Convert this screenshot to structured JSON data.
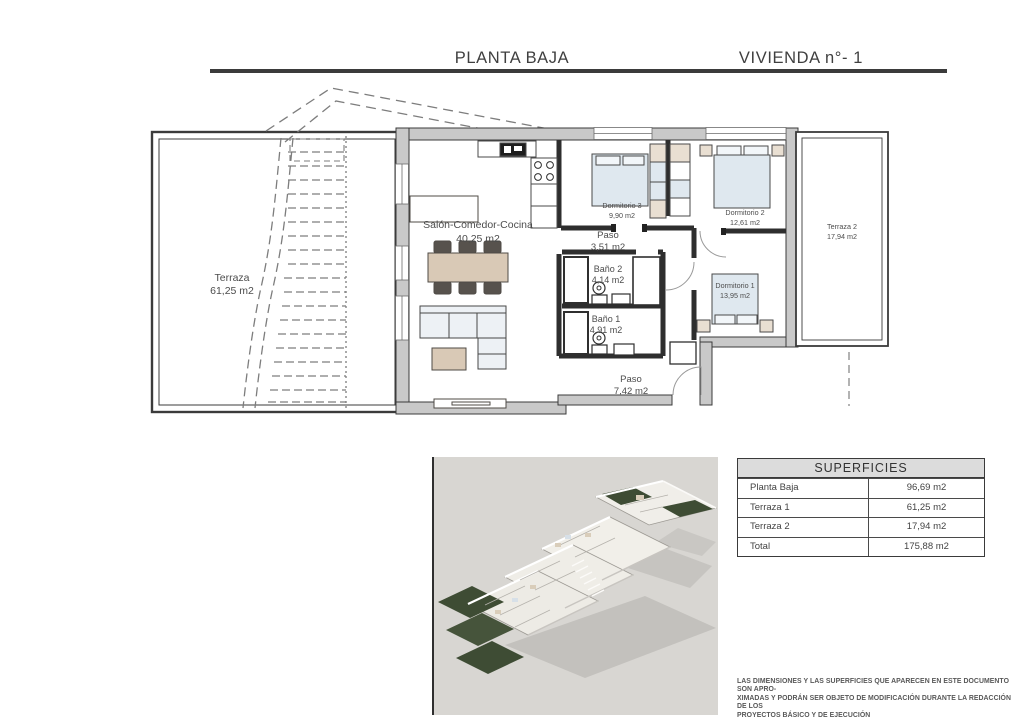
{
  "header": {
    "title_left": "PLANTA BAJA",
    "title_right": "VIVIENDA n°- 1"
  },
  "floorplan": {
    "rooms": {
      "terraza1": {
        "name": "Terraza",
        "area": "61,25 m2"
      },
      "salon": {
        "name": "Salón-Comedor-Cocina",
        "area": "40,25 m2"
      },
      "dormitorio3": {
        "name": "Dormitorio 3",
        "area": "9,90 m2"
      },
      "paso1": {
        "name": "Paso",
        "area": "3,51 m2"
      },
      "bano2": {
        "name": "Baño 2",
        "area": "4,14 m2"
      },
      "dormitorio2": {
        "name": "Dormitorio 2",
        "area": "12,61 m2"
      },
      "terraza2": {
        "name": "Terraza 2",
        "area": "17,94 m2"
      },
      "dormitorio1": {
        "name": "Dormitorio 1",
        "area": "13,95 m2"
      },
      "bano1": {
        "name": "Baño 1",
        "area": "4,91 m2"
      },
      "paso2": {
        "name": "Paso",
        "area": "7,42 m2"
      }
    }
  },
  "superficies_table": {
    "title": "SUPERFICIES",
    "rows": [
      {
        "label": "Planta Baja",
        "value": "96,69 m2"
      },
      {
        "label": "Terraza 1",
        "value": "61,25 m2"
      },
      {
        "label": "Terraza 2",
        "value": "17,94 m2"
      },
      {
        "label": "Total",
        "value": "175,88 m2"
      }
    ]
  },
  "disclaimer": {
    "line1": "LAS DIMENSIONES Y LAS SUPERFICIES QUE APARECEN EN ESTE DOCUMENTO SON APRO-",
    "line2": "XIMADAS Y PODRÁN SER OBJETO DE MODIFICACIÓN DURANTE LA REDACCIÓN DE LOS",
    "line3": "PROYECTOS BÁSICO Y DE EJECUCIÓN"
  },
  "colors": {
    "wall_fill": "#c9c9c9",
    "wall_stroke": "#3b3b3b",
    "bed_fill": "#dfe8ef",
    "wood_fill": "#d9c9b6",
    "render_bg": "#d8d6d2",
    "garden_green": "#3e4c34"
  }
}
